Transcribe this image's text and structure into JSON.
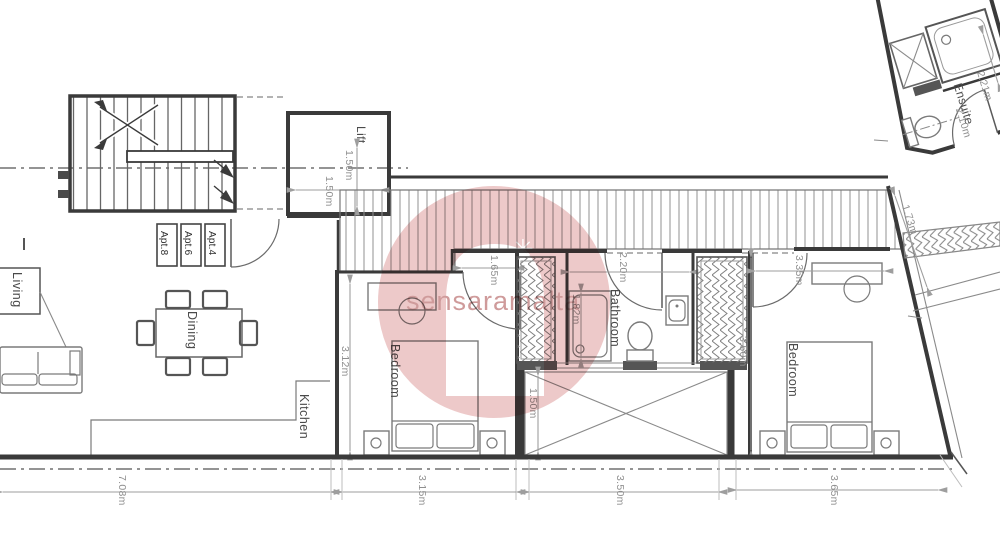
{
  "plan_title": "apartment-floor-plan",
  "rooms": {
    "lift": "Lift",
    "living": "Living",
    "dining": "Dining",
    "kitchen": "Kitchen",
    "bedroom1": "Bedroom",
    "bedroom2": "Bedroom",
    "bathroom": "Bathroom",
    "ensuite": "Ensuite"
  },
  "apartments": {
    "apt8": "Apt.8",
    "apt6": "Apt.6",
    "apt4": "Apt.4"
  },
  "dims": {
    "lift_w": "1.50m",
    "lift_d": "1.50m",
    "hall": "1.65m",
    "bed1_w": "3.12m",
    "bath_w": "2.20m",
    "bath_l": "1.82m",
    "bed2_t": "3.35m",
    "bed2_w": "3.50m",
    "void": "1.50m",
    "total": "7.08m",
    "b1": "3.15m",
    "mid": "3.50m",
    "b2": "3.65m",
    "en_a": "2.21m",
    "en_b": "2.10m",
    "stair": "1.73m"
  },
  "watermark": {
    "text": "sensaramalta",
    "star": "✳"
  },
  "colors": {
    "wall": "#3a3a3a",
    "furniture": "#7a7a7a",
    "dimension": "#9e9e9e",
    "label": "#4a4a4a",
    "watermark_pink": "#edc9c9",
    "watermark_text": "#cf9b9b"
  }
}
